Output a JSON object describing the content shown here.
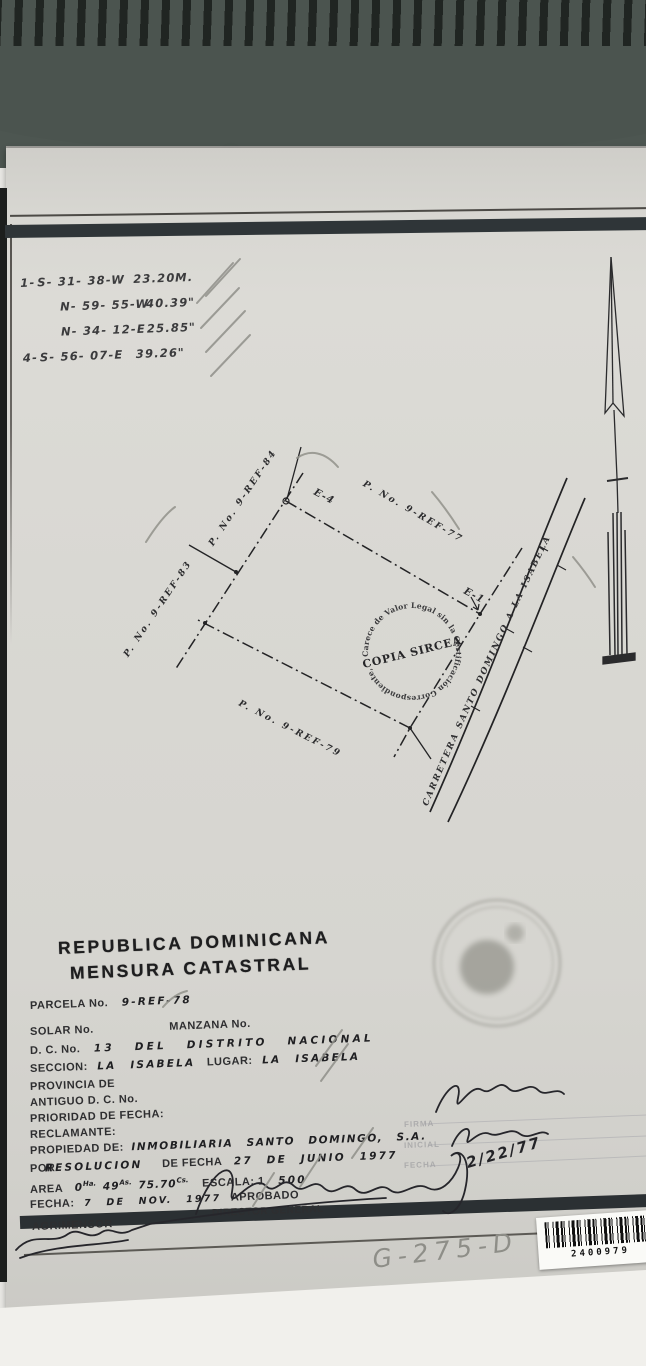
{
  "bearings": {
    "rows": [
      {
        "num": "1-",
        "bearing": "S- 31- 38-W",
        "dist": "23.20",
        "unit": "M."
      },
      {
        "num": "",
        "bearing": "N- 59- 55-W",
        "dist": "40.39",
        "unit": "\""
      },
      {
        "num": "",
        "bearing": "N- 34- 12-E",
        "dist": "25.85",
        "unit": "\""
      },
      {
        "num": "4-",
        "bearing": "S- 56- 07-E",
        "dist": "39.26",
        "unit": "\""
      }
    ]
  },
  "plot": {
    "neighbor_nw": "P. No. 9-REF-84",
    "neighbor_w": "P. No. 9-REF-83",
    "neighbor_n": "P. No. 9-REF-77",
    "neighbor_s": "P. No. 9-REF-79",
    "corner_top": "E-4",
    "corner_right": "E-1",
    "road": "CARRETERA  SANTO DOMINGO  A  LA  ISABELA",
    "watermark": {
      "ring": "Carece de Valor Legal sin la Certificación Correspondiente,",
      "center": "COPIA SIRCEA"
    }
  },
  "form": {
    "title1": "REPUBLICA DOMINICANA",
    "title2": "MENSURA CATASTRAL",
    "parcela_label": "PARCELA No.",
    "parcela_value": "9-REF-78",
    "solar_label": "SOLAR No.",
    "manzana_label": "MANZANA No.",
    "dc_label": "D. C. No.",
    "dc_value": "13  DEL  DISTRITO  NACIONAL",
    "seccion_label": "SECCION:",
    "seccion_value": "LA ISABELA",
    "lugar_label": "LUGAR:",
    "lugar_value": "LA  ISABELA",
    "provincia_label": "PROVINCIA DE",
    "antiguo_label": "ANTIGUO D. C. No.",
    "prioridad_label": "PRIORIDAD DE FECHA:",
    "reclamante_label": "RECLAMANTE:",
    "propiedad_label": "PROPIEDAD DE:",
    "propiedad_value": "INMOBILIARIA  SANTO  DOMINGO,  S.A.",
    "por_label": "POR",
    "por_value": "RESOLUCION",
    "defecha_label": "DE FECHA",
    "defecha_value": "27 DE JUNIO 1977",
    "area_label": "AREA",
    "area": {
      "v1": "0",
      "u1": "Ha.",
      "v2": "49",
      "u2": "As.",
      "v3": "75.70",
      "u3": "Cs."
    },
    "escala_label": "ESCALA: 1",
    "escala_value": "500",
    "fecha_label": "FECHA:",
    "fecha_value": "7 DE NOV. 1977",
    "aprobado_label": "APROBADO",
    "director_label": "DIRECTOR GENERAL",
    "agrimensor_label": "AGRIMENSOR"
  },
  "right_block": {
    "firma_label": "FIRMA",
    "inicial_label": "INICIAL",
    "fecha_label": "FECHA",
    "date_value": "2/22/77"
  },
  "footer": {
    "pencil_code": "G-275-D",
    "barcode_number": "2400979"
  }
}
